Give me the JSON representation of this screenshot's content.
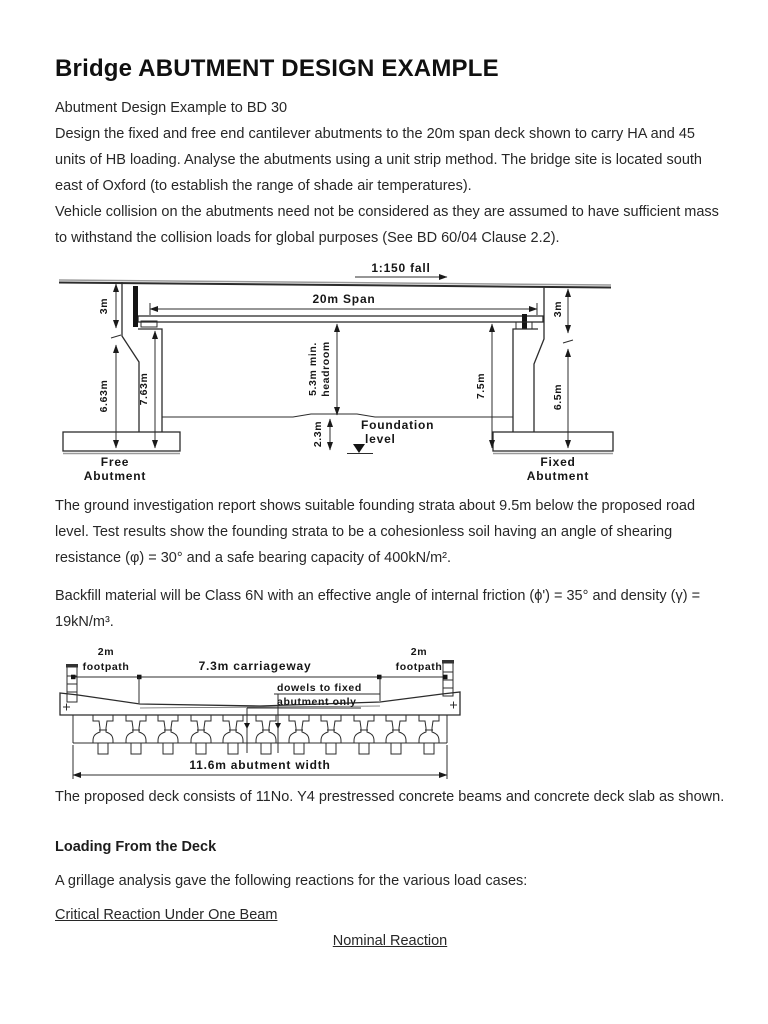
{
  "document": {
    "title": "Bridge ABUTMENT DESIGN EXAMPLE",
    "intro_heading": "Abutment Design Example to BD 30",
    "intro_para": "Design the fixed and free end cantilever abutments to the 20m span deck shown to carry HA and 45 units of HB loading. Analyse the abutments using a unit strip method. The bridge site is located south east of Oxford (to establish the range of shade air temperatures).",
    "collision_para": "Vehicle collision on the abutments need not be considered as they are assumed to have sufficient mass to withstand the collision loads for global purposes (See BD 60/04 Clause 2.2).",
    "ground_para": "The ground investigation report shows suitable founding strata about 9.5m below the proposed road level. Test results show the founding strata to be a cohesionless soil having an angle of shearing resistance (φ) = 30° and a safe bearing capacity of 400kN/m².",
    "backfill_para": "Backfill material will be Class 6N with an effective angle of internal friction (ϕ') = 35° and density (γ) = 19kN/m³.",
    "deck_para": "The proposed deck consists of 11No. Y4 prestressed concrete beams and concrete deck slab as shown.",
    "loading_heading": "Loading From the Deck",
    "loading_para": "A grillage analysis gave the following reactions for the various load cases:",
    "critical_reaction_heading": "Critical Reaction Under One Beam",
    "nominal_reaction_heading": "Nominal Reaction"
  },
  "elevation_diagram": {
    "fall_label": "1:150 fall",
    "span_label": "20m Span",
    "free_upper_dim": "3m",
    "free_stem_dim": "6.63m",
    "free_total_dim": "7.63m",
    "headroom_line1": "5.3m min.",
    "headroom_line2": "headroom",
    "foundation_dim": "2.3m",
    "foundation_label_line1": "Foundation",
    "foundation_label_line2": "level",
    "fixed_total_dim": "7.5m",
    "fixed_upper_dim": "3m",
    "fixed_stem_dim": "6.5m",
    "free_abutment_line1": "Free",
    "free_abutment_line2": "Abutment",
    "fixed_abutment_line1": "Fixed",
    "fixed_abutment_line2": "Abutment"
  },
  "section_diagram": {
    "left_footpath_line1": "2m",
    "left_footpath_line2": "footpath",
    "carriageway_label": "7.3m carriageway",
    "right_footpath_line1": "2m",
    "right_footpath_line2": "footpath",
    "dowels_line1": "dowels to fixed",
    "dowels_line2": "abutment only",
    "width_label": "11.6m abutment width"
  }
}
